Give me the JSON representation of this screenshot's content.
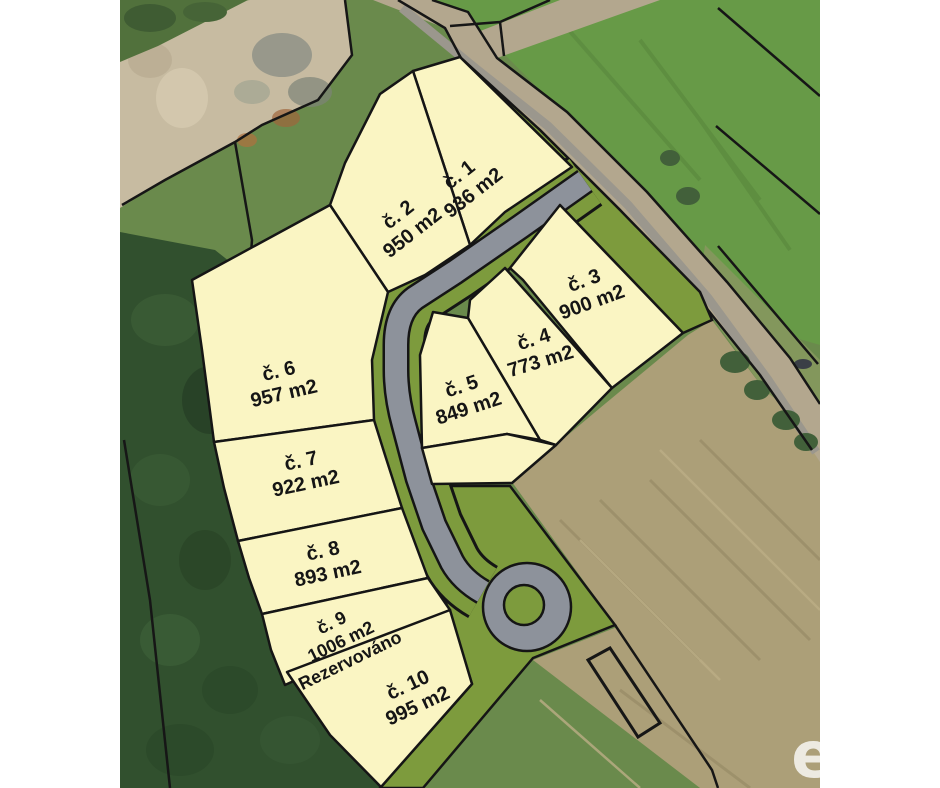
{
  "map": {
    "kind": "land-plot-site-plan-over-aerial-photo",
    "language": "cs",
    "units_label": "m2"
  },
  "parcels": [
    {
      "id": "č. 1",
      "area": "936 m2"
    },
    {
      "id": "č. 2",
      "area": "950 m2"
    },
    {
      "id": "č. 3",
      "area": "900 m2"
    },
    {
      "id": "č. 4",
      "area": "773 m2"
    },
    {
      "id": "č. 5",
      "area": "849 m2"
    },
    {
      "id": "č. 6",
      "area": "957 m2"
    },
    {
      "id": "č. 7",
      "area": "922 m2"
    },
    {
      "id": "č. 8",
      "area": "893 m2"
    },
    {
      "id": "č. 9",
      "area": "1006 m2",
      "status": "Rezervováno"
    },
    {
      "id": "č. 10",
      "area": "995 m2"
    }
  ],
  "watermark": {
    "letter": "e"
  },
  "colors": {
    "parcel_fill": "#faf5c3",
    "green_buffer": "#7d9b3d",
    "new_road": "#8d929b",
    "outline": "#151515",
    "forest": "#31502e",
    "field_bright": "#679a47",
    "field_brown": "#ac9f78",
    "dirt": "#c7bba1",
    "margin": "#ffffff"
  }
}
